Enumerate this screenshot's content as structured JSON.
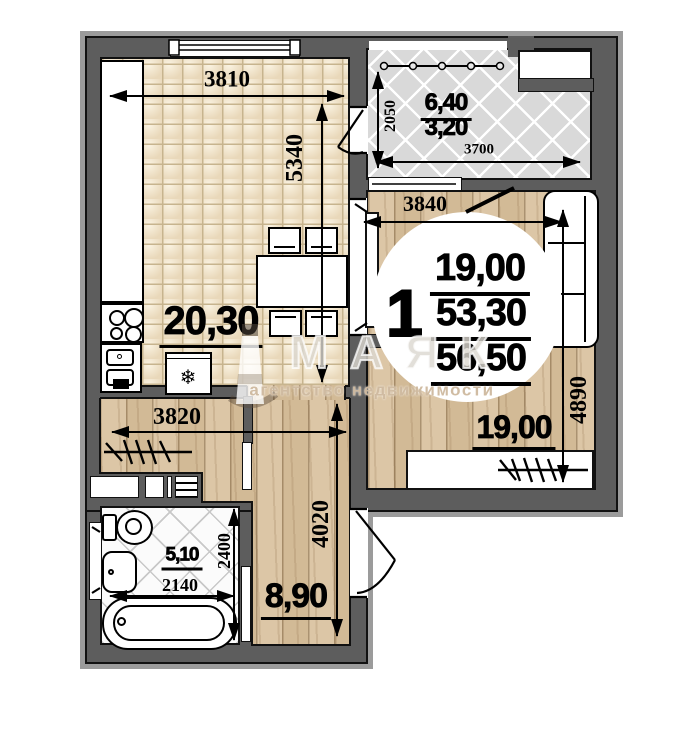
{
  "watermark": {
    "brand": "МАЯК",
    "tagline": "агентство недвижимости"
  },
  "unit": {
    "rooms_count": "1",
    "area_living": "19,00",
    "area_secondary": "53,30",
    "area_total": "56,50"
  },
  "labels": {
    "kitchen_area": "20,30",
    "room_area": "19,00",
    "hall_area": "8,90",
    "bathroom_area": "5,10",
    "balcony_area_full": "6,40",
    "balcony_area_reduced": "3,20"
  },
  "dimensions": {
    "kitchen_width": "3810",
    "kitchen_length": "5340",
    "balcony_depth": "2050",
    "balcony_width": "3700",
    "room_width": "3840",
    "room_length": "4890",
    "hall_width": "3820",
    "hall_length": "4020",
    "bathroom_width": "2140",
    "bathroom_depth": "2400"
  },
  "symbols": {
    "fridge_snowflake": "❄"
  },
  "colors": {
    "wall": "#5d5d5d",
    "wall_shadow": "#9b9b9b",
    "outline": "#111111",
    "wood_floor": "#d8c2a1",
    "tile_floor": "#ecdfc6",
    "lattice_floor": "#d9d9d9"
  }
}
